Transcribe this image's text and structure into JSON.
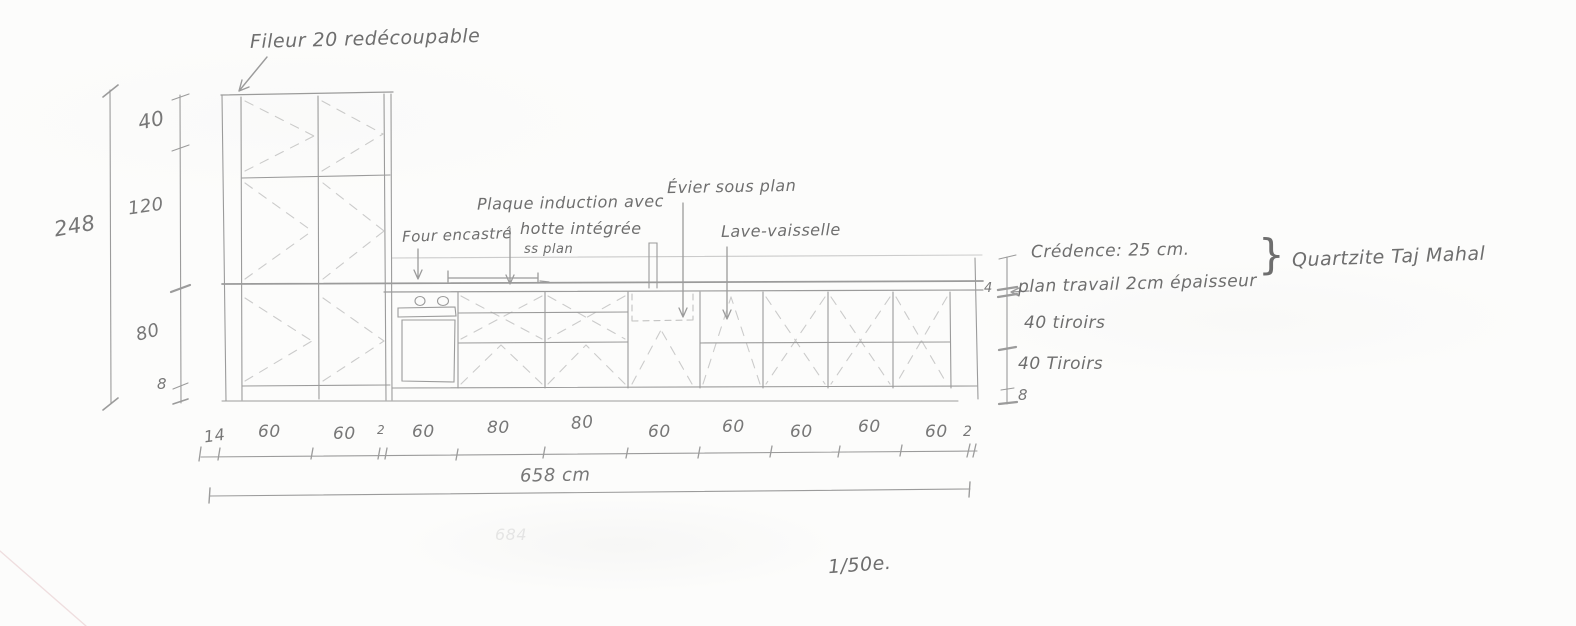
{
  "page": {
    "background": "#fcfcfb",
    "ink": "#828282"
  },
  "notes": {
    "filler": "Fileur 20 redécoupable",
    "oven": "Four encastré",
    "induction_1": "Plaque induction avec",
    "induction_2": "hotte intégrée",
    "induction_3": "ss plan",
    "sink": "Évier sous plan",
    "dishwasher": "Lave-vaisselle",
    "credence": "Crédence: 25 cm.",
    "worktop": "plan travail 2cm épaisseur",
    "material_brace": "}",
    "material": "Quartzite Taj Mahal",
    "drawers_top": "40 tiroirs",
    "drawers_bottom": "40 Tiroirs",
    "worktop_thickness": "4",
    "plinth_right": "8",
    "scale": "1/50e.",
    "faint_erased": "684"
  },
  "dimensions": {
    "left_total": "248",
    "left_segments": [
      "40",
      "120",
      "80",
      "8"
    ],
    "bottom_segments": [
      "14",
      "60",
      "60",
      "2",
      "60",
      "80",
      "80",
      "60",
      "60",
      "60",
      "60",
      "60",
      "2"
    ],
    "total_width": "658 cm"
  }
}
